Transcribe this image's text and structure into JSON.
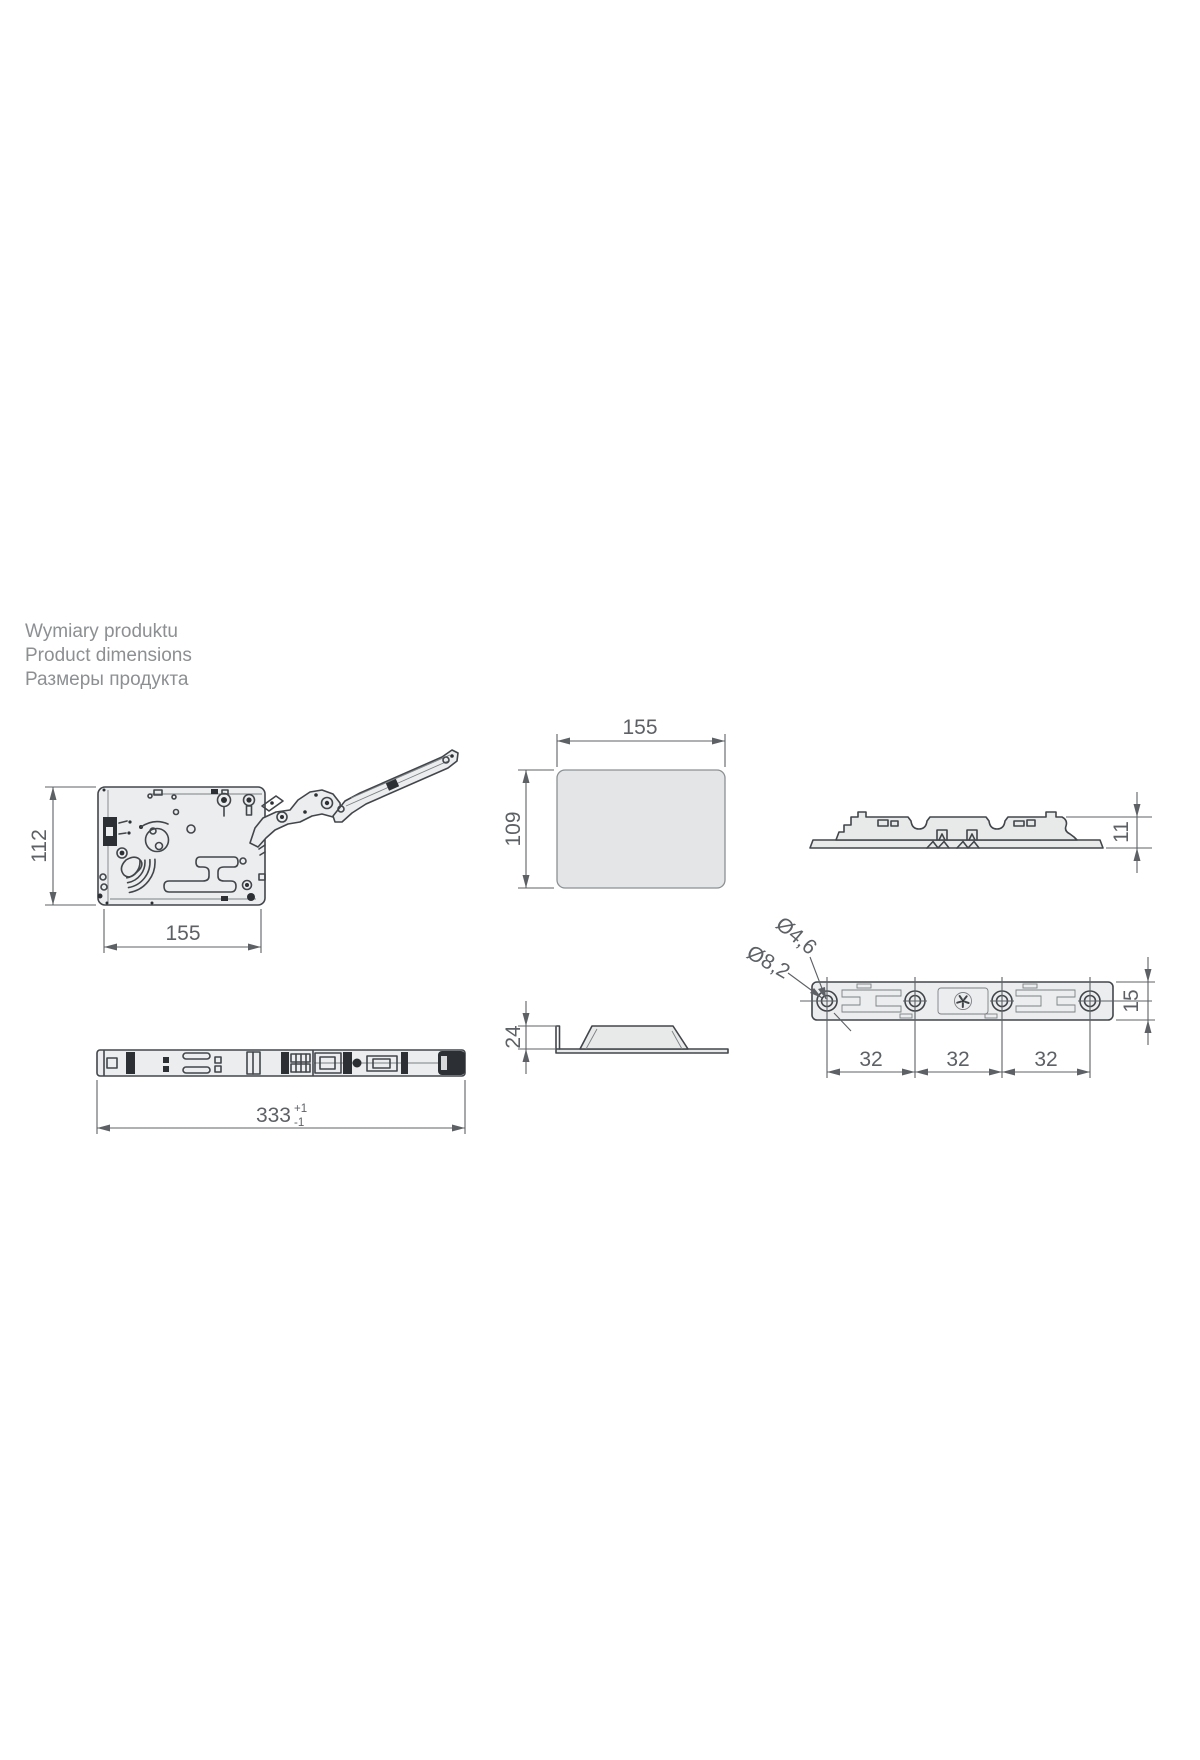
{
  "header": {
    "title_pl": "Wymiary produktu",
    "title_en": "Product dimensions",
    "title_ru": "Размеры продукта"
  },
  "dims": {
    "front": {
      "height": "112",
      "width": "155"
    },
    "cover_top": {
      "width": "155",
      "depth": "109"
    },
    "plate_side": {
      "height": "11"
    },
    "rail": {
      "length": "333",
      "tol_plus": "+1",
      "tol_minus": "-1"
    },
    "cap_side": {
      "height": "24"
    },
    "plate_top": {
      "hole_small": "Ø4,6",
      "hole_large": "Ø8,2",
      "pitch_1": "32",
      "pitch_2": "32",
      "pitch_3": "32",
      "height": "15"
    }
  },
  "colors": {
    "outline": "#42464b",
    "part_fill": "#ecedee",
    "dimension": "#5d6165",
    "heading_text": "#8d9093",
    "background": "#ffffff"
  }
}
